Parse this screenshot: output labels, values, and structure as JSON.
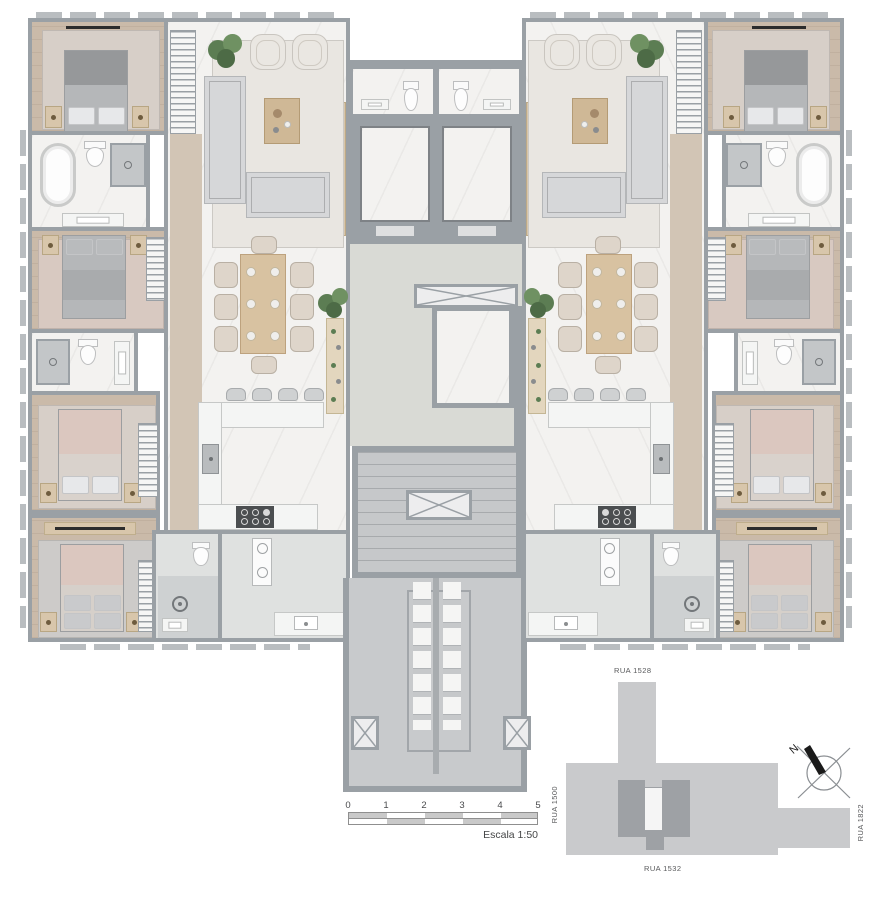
{
  "scale_bar": {
    "ticks": [
      "0",
      "1",
      "2",
      "3",
      "4",
      "5"
    ],
    "label": "Escala 1:50"
  },
  "site_map": {
    "street_top": "RUA 1528",
    "street_left": "RUA 1500",
    "street_right": "RUA 1822",
    "street_bottom": "RUA 1532",
    "compass_north_label": "N"
  },
  "colors": {
    "wall": "#9aa0a5",
    "wood": "#cabaa9",
    "wood-light": "#d2c5b5",
    "marble": "#f3f2f0",
    "pale": "#d9dad5",
    "gray-floor": "#dfe1e0",
    "core-floor": "#c6c8ca",
    "rug-living": "#e9e6e1",
    "rug-tan": "#d7cfc8",
    "rug-pink": "#d8c9c1",
    "rug-gray": "#cdcbc9",
    "bed-gray": "#b5b7b9",
    "bed-pink": "#dbc7bf",
    "tan": "#d8c6ab",
    "table-wood": "#d8c2a1",
    "plant": "#5c7d53",
    "accent-brown": "#a58a6b",
    "appliance": "#4b4e50",
    "site-light": "#c9cacc",
    "site-dark": "#9ea1a5",
    "ink": "#4a4b4d"
  }
}
